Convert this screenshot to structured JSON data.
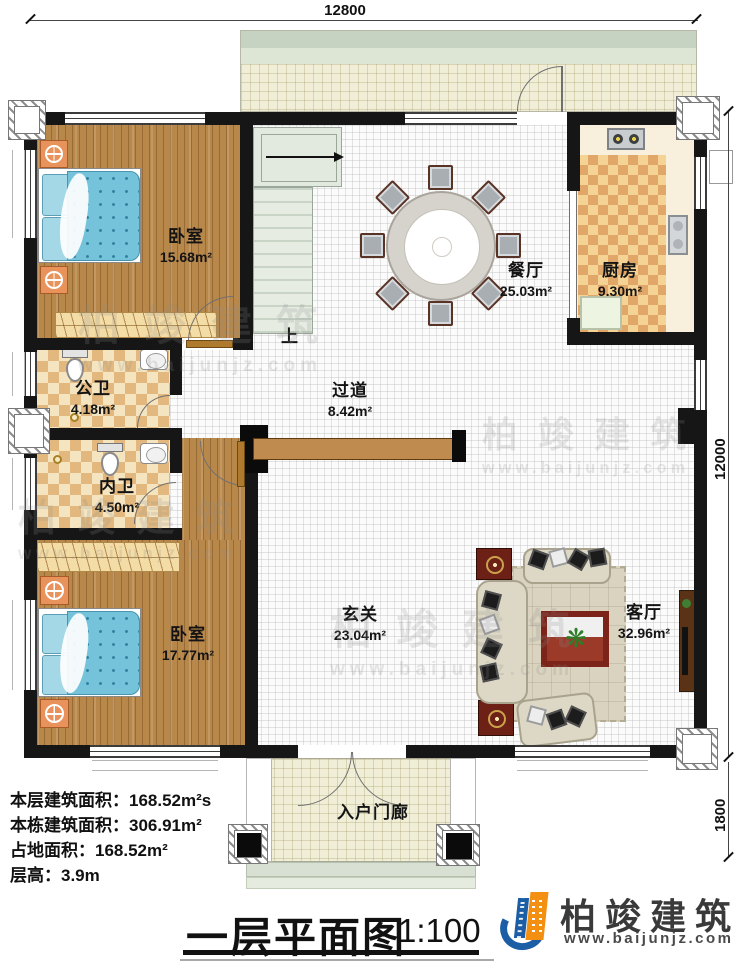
{
  "title_block": {
    "title": "一层平面图",
    "scale": "1:100"
  },
  "logo": {
    "name": "柏竣建筑",
    "url": "www.baijunjz.com"
  },
  "watermark": {
    "brand": "柏竣建筑",
    "url": "www.baijunjz.com"
  },
  "dimensions": {
    "top": "12800",
    "right": "12000",
    "bottom_right": "1800"
  },
  "stairs": {
    "up_label": "上"
  },
  "info_lines": [
    "本层建筑面积：168.52m²s",
    "本栋建筑面积：306.91m²",
    "占地面积：168.52m²",
    "层高：3.9m"
  ],
  "rooms": {
    "bedroom_top": {
      "name": "卧室",
      "area": "15.68m²"
    },
    "dining": {
      "name": "餐厅",
      "area": "25.03m²"
    },
    "kitchen": {
      "name": "厨房",
      "area": "9.30m²"
    },
    "bath_public": {
      "name": "公卫",
      "area": "4.18m²"
    },
    "corridor": {
      "name": "过道",
      "area": "8.42m²"
    },
    "bath_private": {
      "name": "内卫",
      "area": "4.50m²"
    },
    "bedroom_bottom": {
      "name": "卧室",
      "area": "17.77m²"
    },
    "foyer": {
      "name": "玄关",
      "area": "23.04m²"
    },
    "living": {
      "name": "客厅",
      "area": "32.96m²"
    },
    "porch": {
      "name": "入户门廊"
    }
  },
  "colors": {
    "wall": "#161616",
    "wood": "#b8874a",
    "bath_tile_dark": "#e2b87f",
    "bath_tile_light": "#f4e4c0",
    "kitchen_tile_dark": "#e0a768",
    "kitchen_tile_light": "#f5d395",
    "bed_blue": "#74c3da",
    "stairs_green": "#dfe7dc",
    "logo_orange": "#f39012",
    "logo_blue": "#1b5ea6"
  }
}
